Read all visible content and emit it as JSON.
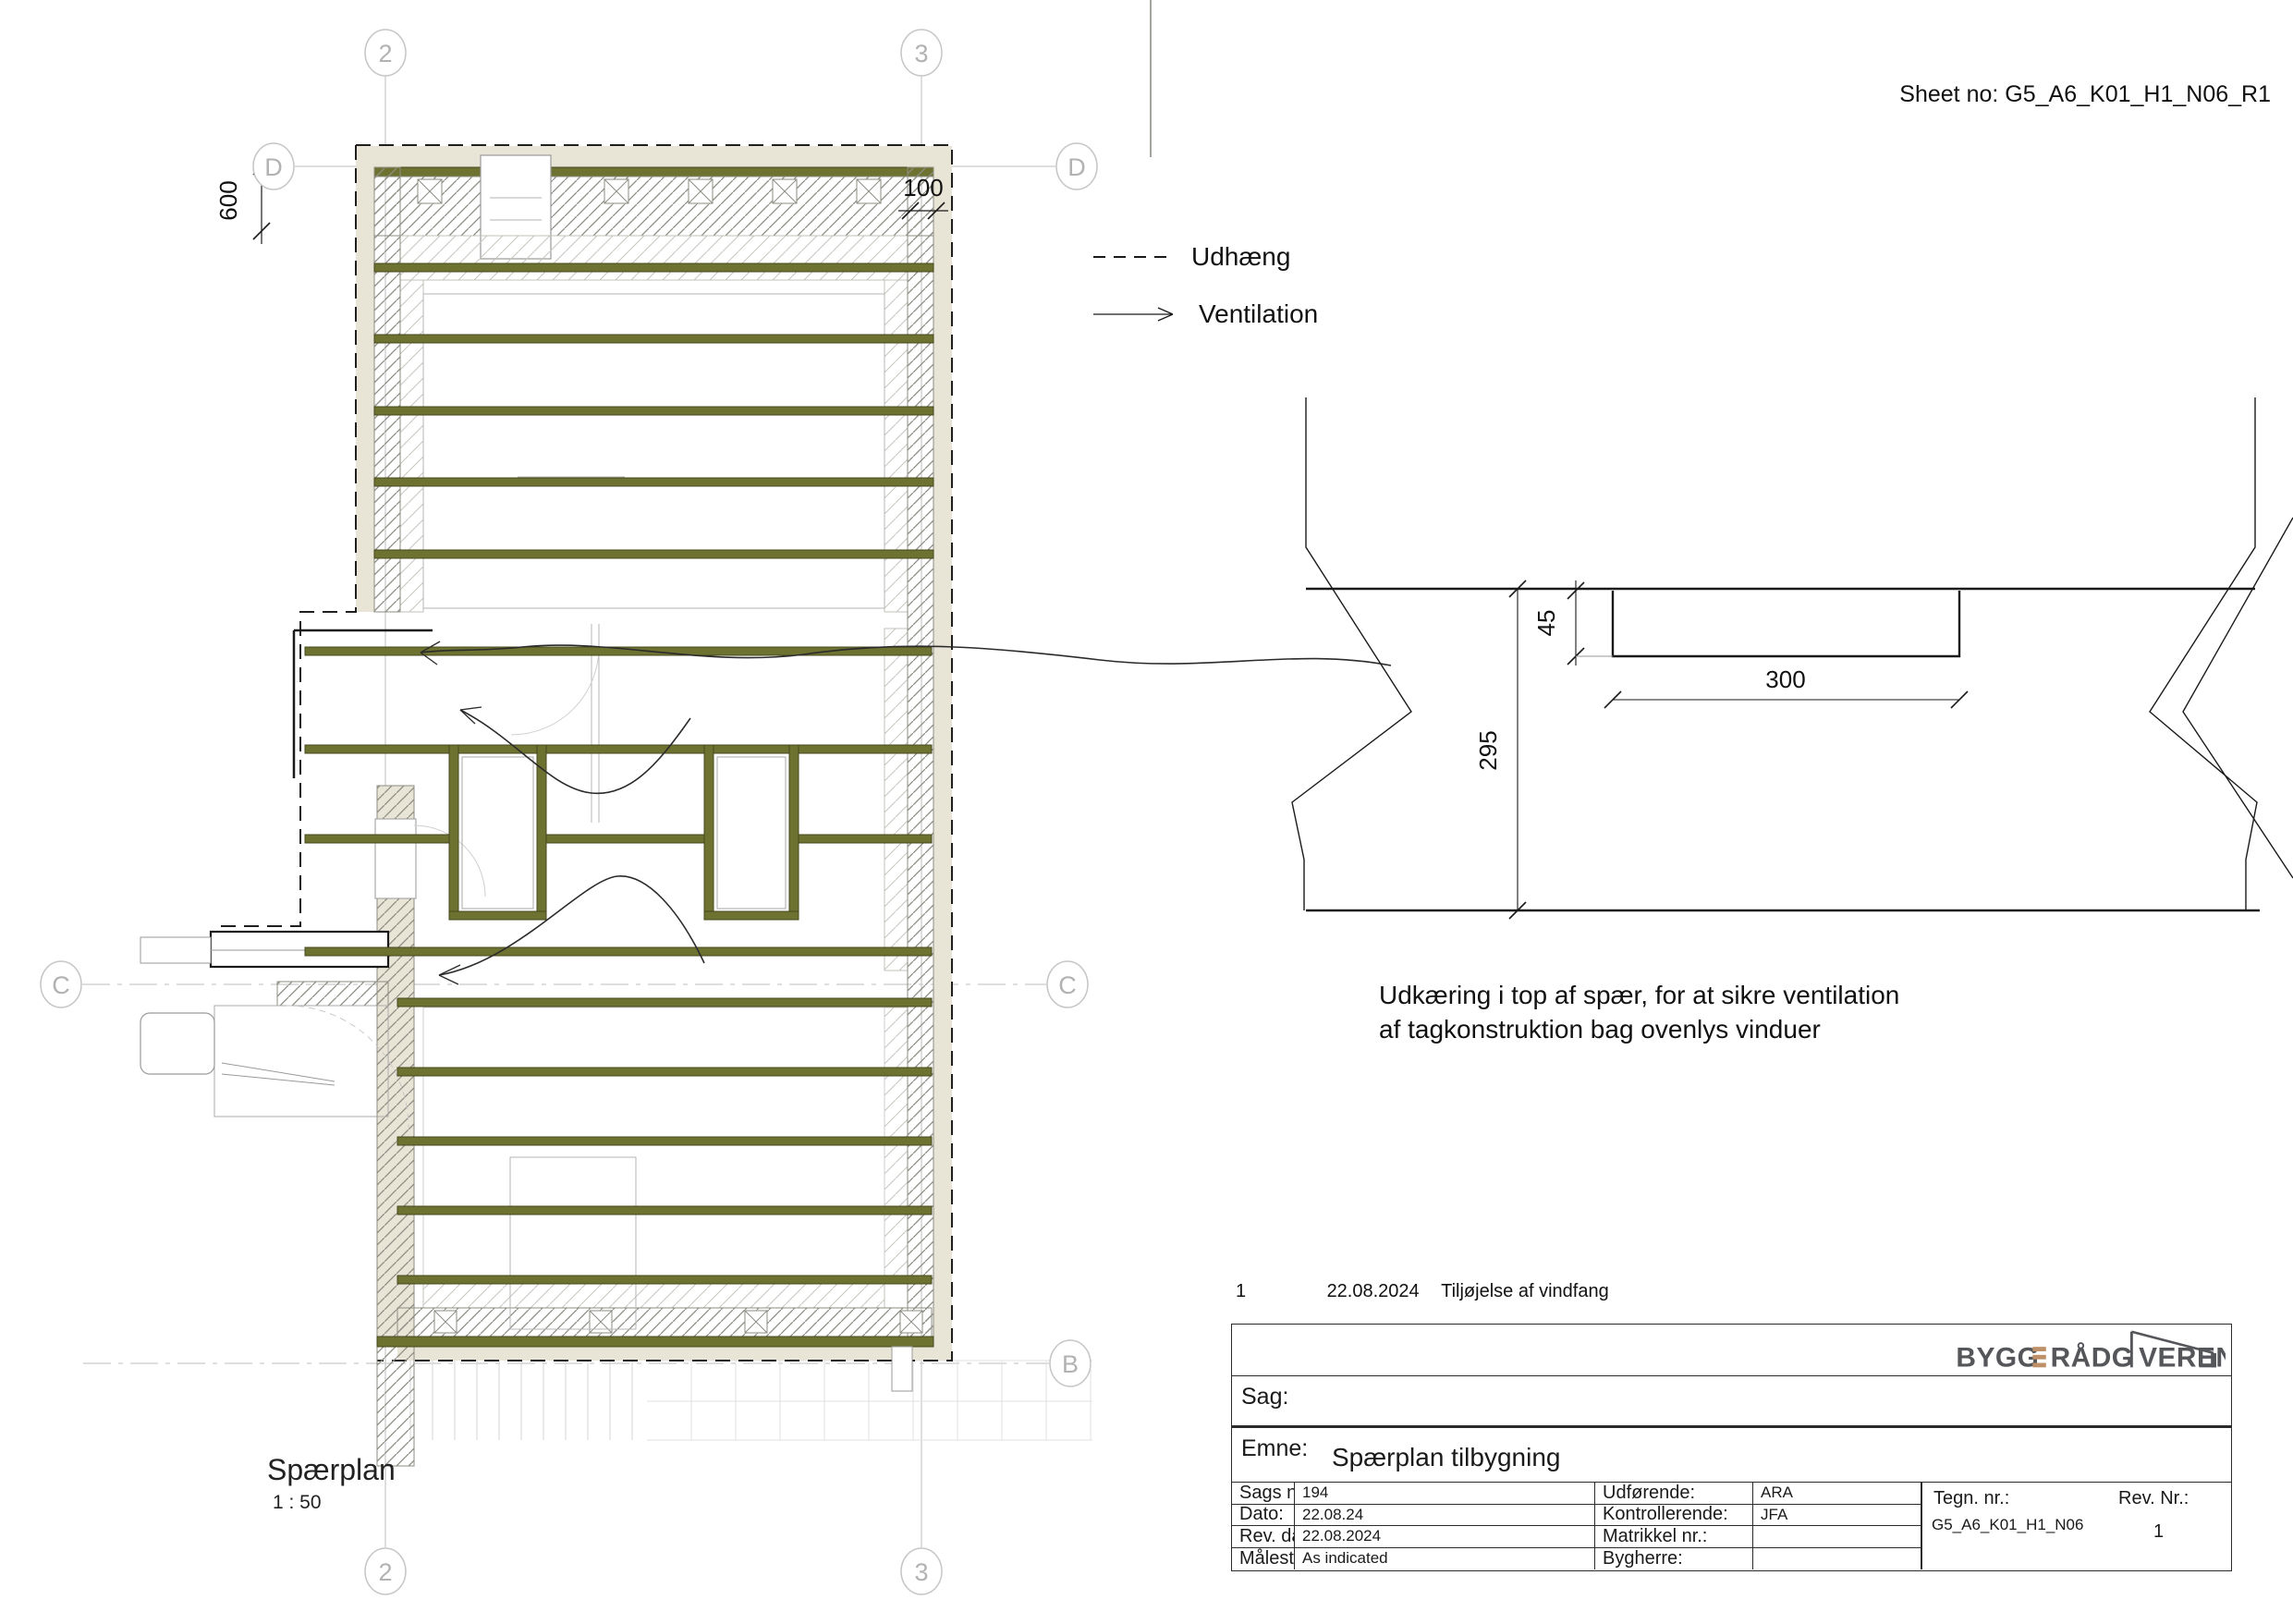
{
  "sheet": {
    "label": "Sheet no:",
    "number": "G5_A6_K01_H1_N06_R1"
  },
  "legend": {
    "udhaeng": "Udhæng",
    "ventilation": "Ventilation"
  },
  "plan": {
    "title": "Spærplan",
    "scale": "1 : 50",
    "grids": {
      "col_2": "2",
      "col_3": "3",
      "row_d": "D",
      "row_c": "C",
      "row_b": "B"
    },
    "dims": {
      "eave_overhang": "600",
      "side_overhang": "100"
    }
  },
  "detail": {
    "dims": {
      "notch_depth": "45",
      "notch_length": "300",
      "rafter_height": "295"
    },
    "note_line1": "Udkæring i top af spær, for at sikre ventilation",
    "note_line2": "af tagkonstruktion bag ovenlys vinduer"
  },
  "revision": {
    "number": "1",
    "date": "22.08.2024",
    "description": "Tiljøjelse af vindfang"
  },
  "titleblock": {
    "logo": {
      "part1": "BYGG",
      "part2": "RÅDG",
      "part3": "VEREN"
    },
    "sag_label": "Sag:",
    "emne_label": "Emne:",
    "emne_value": "Spærplan tilbygning",
    "fields": {
      "sags_nr_label": "Sags nr.:",
      "sags_nr_value": "194",
      "dato_label": "Dato:",
      "dato_value": "22.08.24",
      "rev_dato_label": "Rev. dato:",
      "rev_dato_value": "22.08.2024",
      "maalestok_label": "Målestok:",
      "maalestok_sup": "A3",
      "maalestok_value": "As indicated",
      "udfoerende_label": "Udførende:",
      "udfoerende_value": "ARA",
      "kontrollerende_label": "Kontrollerende:",
      "kontrollerende_value": "JFA",
      "matrikkel_label": "Matrikkel nr.:",
      "matrikkel_value": "",
      "bygherre_label": "Bygherre:",
      "bygherre_value": "",
      "tegn_nr_label": "Tegn. nr.:",
      "tegn_nr_value": "G5_A6_K01_H1_N06",
      "rev_nr_label": "Rev. Nr.:",
      "rev_nr_value": "1"
    }
  },
  "colors": {
    "rafter": "#6e7231",
    "rafter_edge": "#45481d",
    "eave_fill": "#e9e5d6",
    "logo_text": "#55565a",
    "logo_accent": "#bf9068",
    "grid": "#c6c6c6"
  }
}
